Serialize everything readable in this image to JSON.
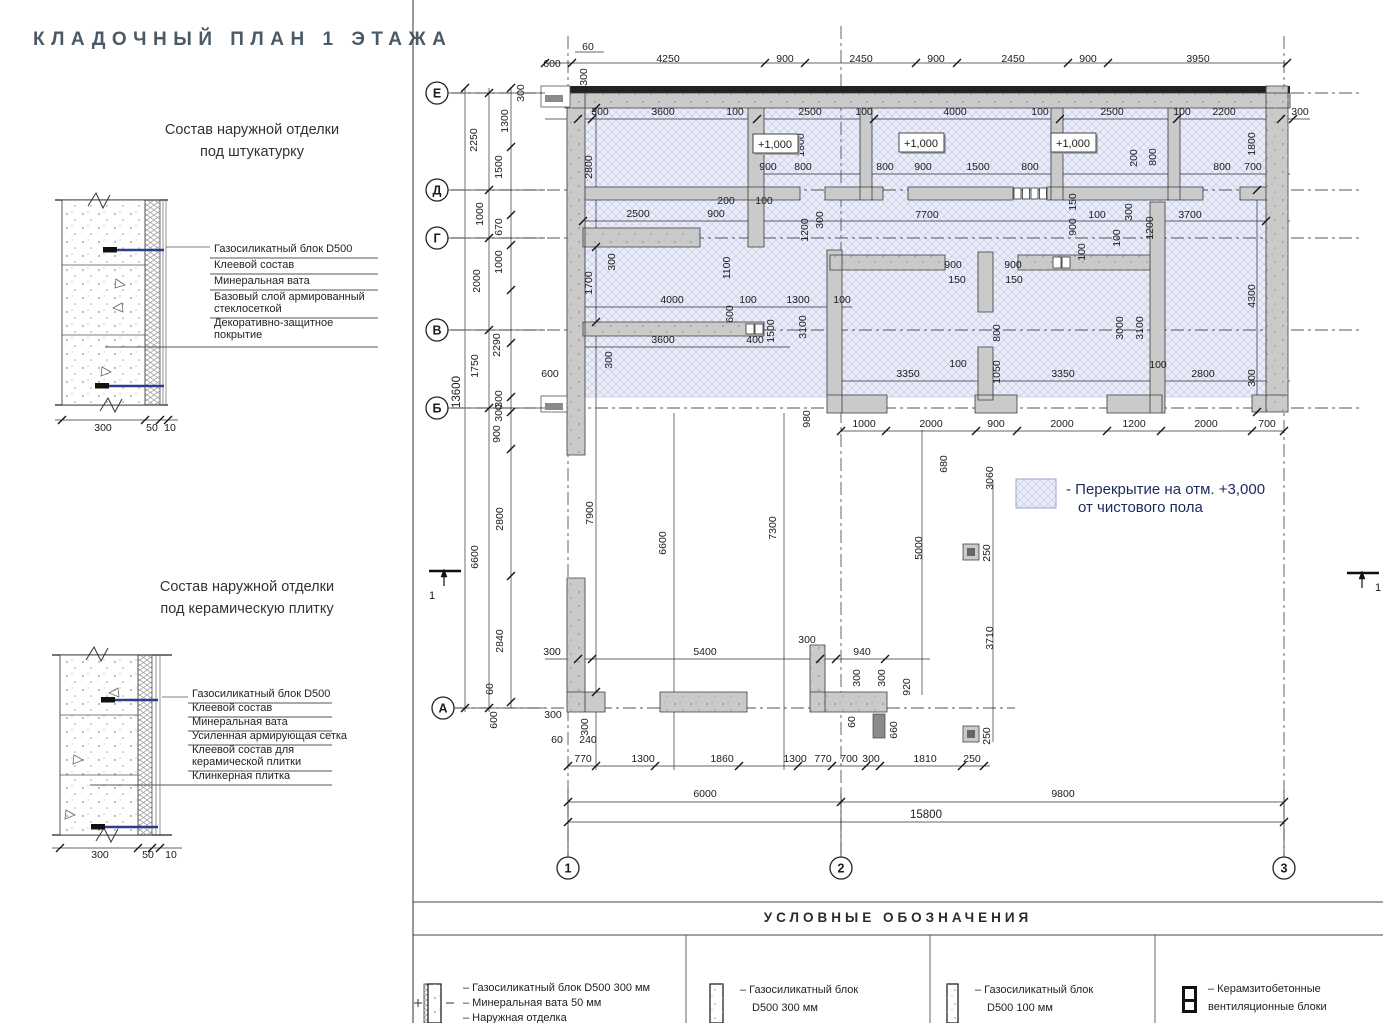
{
  "page": {
    "title": "КЛАДОЧНЫЙ ПЛАН 1 ЭТАЖА"
  },
  "details": [
    {
      "title1": "Состав наружной отделки",
      "title2": "под штукатурку",
      "layer_lines": [
        "Газосиликатный блок D500",
        "Клеевой состав",
        "Минеральная вата",
        "Базовый слой армированный",
        "стеклосеткой",
        "Декоративно-защитное",
        "покрытие"
      ],
      "dims": [
        "300",
        "50",
        "10"
      ]
    },
    {
      "title1": "Состав наружной отделки",
      "title2": "под керамическую плитку",
      "layer_lines": [
        "Газосиликатный блок D500",
        "Клеевой состав",
        "Минеральная вата",
        "Усиленная армирующая сетка",
        "Клеевой состав для",
        "керамической плитки",
        "Клинкерная плитка"
      ],
      "dims": [
        "300",
        "50",
        "10"
      ]
    }
  ],
  "plan": {
    "grid_rows": [
      {
        "label": "Е",
        "x": 437,
        "y": 93
      },
      {
        "label": "Д",
        "x": 437,
        "y": 190
      },
      {
        "label": "Г",
        "x": 437,
        "y": 238
      },
      {
        "label": "В",
        "x": 437,
        "y": 330
      },
      {
        "label": "Б",
        "x": 437,
        "y": 408
      },
      {
        "label": "А",
        "x": 443,
        "y": 708
      }
    ],
    "grid_cols": [
      {
        "label": "1",
        "x": 568,
        "y": 868
      },
      {
        "label": "2",
        "x": 841,
        "y": 868
      },
      {
        "label": "3",
        "x": 1284,
        "y": 868
      }
    ],
    "levels": [
      {
        "t": "+1,000",
        "x": 775,
        "y": 144
      },
      {
        "t": "+1,000",
        "x": 921,
        "y": 143
      },
      {
        "t": "+1,000",
        "x": 1073,
        "y": 143
      }
    ],
    "slab_note": [
      "- Перекрытие на отм. +3,000",
      "от чистового пола"
    ],
    "section_marks": [
      {
        "t": "1",
        "x": 432,
        "y": 599
      },
      {
        "t": "1",
        "x": 1378,
        "y": 591
      }
    ],
    "dims_h": [
      {
        "t": "60",
        "x": 588,
        "y": 50
      },
      {
        "t": "600",
        "x": 552,
        "y": 67
      },
      {
        "t": "4250",
        "x": 668,
        "y": 62
      },
      {
        "t": "900",
        "x": 785,
        "y": 62
      },
      {
        "t": "2450",
        "x": 861,
        "y": 62
      },
      {
        "t": "900",
        "x": 936,
        "y": 62
      },
      {
        "t": "2450",
        "x": 1013,
        "y": 62
      },
      {
        "t": "900",
        "x": 1088,
        "y": 62
      },
      {
        "t": "3950",
        "x": 1198,
        "y": 62
      },
      {
        "t": "300",
        "x": 600,
        "y": 115
      },
      {
        "t": "3600",
        "x": 663,
        "y": 115
      },
      {
        "t": "100",
        "x": 735,
        "y": 115
      },
      {
        "t": "2500",
        "x": 810,
        "y": 115
      },
      {
        "t": "100",
        "x": 864,
        "y": 115
      },
      {
        "t": "4000",
        "x": 955,
        "y": 115
      },
      {
        "t": "100",
        "x": 1040,
        "y": 115
      },
      {
        "t": "2500",
        "x": 1112,
        "y": 115
      },
      {
        "t": "100",
        "x": 1182,
        "y": 115
      },
      {
        "t": "2200",
        "x": 1224,
        "y": 115
      },
      {
        "t": "300",
        "x": 1300,
        "y": 115
      },
      {
        "t": "900",
        "x": 768,
        "y": 170
      },
      {
        "t": "800",
        "x": 803,
        "y": 170
      },
      {
        "t": "800",
        "x": 885,
        "y": 170
      },
      {
        "t": "900",
        "x": 923,
        "y": 170
      },
      {
        "t": "1500",
        "x": 978,
        "y": 170
      },
      {
        "t": "800",
        "x": 1030,
        "y": 170
      },
      {
        "t": "800",
        "x": 1222,
        "y": 170
      },
      {
        "t": "700",
        "x": 1253,
        "y": 170
      },
      {
        "t": "200",
        "x": 726,
        "y": 204
      },
      {
        "t": "100",
        "x": 764,
        "y": 204
      },
      {
        "t": "2500",
        "x": 638,
        "y": 217
      },
      {
        "t": "900",
        "x": 716,
        "y": 217
      },
      {
        "t": "7700",
        "x": 927,
        "y": 218
      },
      {
        "t": "100",
        "x": 1097,
        "y": 218
      },
      {
        "t": "3700",
        "x": 1190,
        "y": 218
      },
      {
        "t": "900",
        "x": 953,
        "y": 268
      },
      {
        "t": "900",
        "x": 1013,
        "y": 268
      },
      {
        "t": "150",
        "x": 957,
        "y": 283
      },
      {
        "t": "150",
        "x": 1014,
        "y": 283
      },
      {
        "t": "4000",
        "x": 672,
        "y": 303
      },
      {
        "t": "100",
        "x": 748,
        "y": 303
      },
      {
        "t": "1300",
        "x": 798,
        "y": 303
      },
      {
        "t": "100",
        "x": 842,
        "y": 303
      },
      {
        "t": "3600",
        "x": 663,
        "y": 343
      },
      {
        "t": "400",
        "x": 755,
        "y": 343
      },
      {
        "t": "600",
        "x": 550,
        "y": 377
      },
      {
        "t": "3350",
        "x": 908,
        "y": 377
      },
      {
        "t": "100",
        "x": 958,
        "y": 367
      },
      {
        "t": "3350",
        "x": 1063,
        "y": 377
      },
      {
        "t": "100",
        "x": 1158,
        "y": 368
      },
      {
        "t": "2800",
        "x": 1203,
        "y": 377
      },
      {
        "t": "1000",
        "x": 864,
        "y": 427
      },
      {
        "t": "2000",
        "x": 931,
        "y": 427
      },
      {
        "t": "900",
        "x": 996,
        "y": 427
      },
      {
        "t": "2000",
        "x": 1062,
        "y": 427
      },
      {
        "t": "1200",
        "x": 1134,
        "y": 427
      },
      {
        "t": "2000",
        "x": 1206,
        "y": 427
      },
      {
        "t": "700",
        "x": 1267,
        "y": 427
      },
      {
        "t": "300",
        "x": 552,
        "y": 655
      },
      {
        "t": "5400",
        "x": 705,
        "y": 655
      },
      {
        "t": "300",
        "x": 807,
        "y": 643
      },
      {
        "t": "940",
        "x": 862,
        "y": 655
      },
      {
        "t": "300",
        "x": 553,
        "y": 718
      },
      {
        "t": "60",
        "x": 557,
        "y": 743
      },
      {
        "t": "240",
        "x": 588,
        "y": 743
      },
      {
        "t": "770",
        "x": 583,
        "y": 762
      },
      {
        "t": "1300",
        "x": 643,
        "y": 762
      },
      {
        "t": "1860",
        "x": 722,
        "y": 762
      },
      {
        "t": "1300",
        "x": 795,
        "y": 762
      },
      {
        "t": "770",
        "x": 823,
        "y": 762
      },
      {
        "t": "700",
        "x": 849,
        "y": 762
      },
      {
        "t": "300",
        "x": 871,
        "y": 762
      },
      {
        "t": "1810",
        "x": 925,
        "y": 762
      },
      {
        "t": "250",
        "x": 972,
        "y": 762
      },
      {
        "t": "6000",
        "x": 705,
        "y": 797
      },
      {
        "t": "9800",
        "x": 1063,
        "y": 797
      },
      {
        "t": "15800",
        "x": 926,
        "y": 818
      }
    ],
    "dims_v": [
      {
        "t": "300",
        "x": 524,
        "y": 93
      },
      {
        "t": "300",
        "x": 587,
        "y": 77
      },
      {
        "t": "1300",
        "x": 508,
        "y": 121
      },
      {
        "t": "2250",
        "x": 477,
        "y": 140
      },
      {
        "t": "1500",
        "x": 502,
        "y": 167
      },
      {
        "t": "1000",
        "x": 483,
        "y": 214
      },
      {
        "t": "670",
        "x": 502,
        "y": 227
      },
      {
        "t": "1000",
        "x": 502,
        "y": 262
      },
      {
        "t": "2000",
        "x": 480,
        "y": 281
      },
      {
        "t": "2290",
        "x": 500,
        "y": 345
      },
      {
        "t": "1750",
        "x": 478,
        "y": 366
      },
      {
        "t": "13600",
        "x": 460,
        "y": 392
      },
      {
        "t": "300",
        "x": 502,
        "y": 399
      },
      {
        "t": "300",
        "x": 502,
        "y": 413
      },
      {
        "t": "900",
        "x": 500,
        "y": 434
      },
      {
        "t": "2800",
        "x": 503,
        "y": 519
      },
      {
        "t": "6600",
        "x": 478,
        "y": 557
      },
      {
        "t": "2840",
        "x": 503,
        "y": 641
      },
      {
        "t": "60",
        "x": 493,
        "y": 689
      },
      {
        "t": "600",
        "x": 497,
        "y": 720
      },
      {
        "t": "300",
        "x": 588,
        "y": 727
      },
      {
        "t": "2800",
        "x": 592,
        "y": 167
      },
      {
        "t": "1700",
        "x": 592,
        "y": 283
      },
      {
        "t": "7900",
        "x": 593,
        "y": 513
      },
      {
        "t": "300",
        "x": 615,
        "y": 262
      },
      {
        "t": "300",
        "x": 612,
        "y": 360
      },
      {
        "t": "1100",
        "x": 730,
        "y": 268
      },
      {
        "t": "600",
        "x": 733,
        "y": 314
      },
      {
        "t": "1500",
        "x": 774,
        "y": 331
      },
      {
        "t": "3100",
        "x": 806,
        "y": 327
      },
      {
        "t": "1800",
        "x": 804,
        "y": 145
      },
      {
        "t": "1800",
        "x": 1255,
        "y": 144
      },
      {
        "t": "200",
        "x": 1137,
        "y": 158
      },
      {
        "t": "800",
        "x": 1156,
        "y": 157
      },
      {
        "t": "300",
        "x": 1132,
        "y": 212
      },
      {
        "t": "1200",
        "x": 1153,
        "y": 228
      },
      {
        "t": "100",
        "x": 1120,
        "y": 238
      },
      {
        "t": "1200",
        "x": 808,
        "y": 230
      },
      {
        "t": "300",
        "x": 823,
        "y": 220
      },
      {
        "t": "150",
        "x": 1076,
        "y": 202
      },
      {
        "t": "900",
        "x": 1076,
        "y": 227
      },
      {
        "t": "100",
        "x": 1085,
        "y": 252
      },
      {
        "t": "800",
        "x": 1000,
        "y": 333
      },
      {
        "t": "1050",
        "x": 1000,
        "y": 372
      },
      {
        "t": "3000",
        "x": 1123,
        "y": 328
      },
      {
        "t": "3100",
        "x": 1143,
        "y": 328
      },
      {
        "t": "4300",
        "x": 1255,
        "y": 296
      },
      {
        "t": "300",
        "x": 1255,
        "y": 378
      },
      {
        "t": "980",
        "x": 810,
        "y": 419
      },
      {
        "t": "680",
        "x": 947,
        "y": 464
      },
      {
        "t": "3060",
        "x": 993,
        "y": 478
      },
      {
        "t": "5000",
        "x": 922,
        "y": 548
      },
      {
        "t": "3710",
        "x": 993,
        "y": 638
      },
      {
        "t": "250",
        "x": 990,
        "y": 553
      },
      {
        "t": "250",
        "x": 990,
        "y": 736
      },
      {
        "t": "300",
        "x": 860,
        "y": 678
      },
      {
        "t": "300",
        "x": 885,
        "y": 678
      },
      {
        "t": "920",
        "x": 910,
        "y": 687
      },
      {
        "t": "660",
        "x": 897,
        "y": 730
      },
      {
        "t": "60",
        "x": 855,
        "y": 722
      },
      {
        "t": "6600",
        "x": 666,
        "y": 543
      },
      {
        "t": "7300",
        "x": 776,
        "y": 528
      }
    ]
  },
  "legend": {
    "title": "УСЛОВНЫЕ ОБОЗНАЧЕНИЯ",
    "items": [
      {
        "lines": [
          "– Газосиликатный блок D500 300 мм",
          "– Минеральная вата 50 мм",
          "– Наружная отделка"
        ]
      },
      {
        "lines": [
          "– Газосиликатный блок",
          "D500 300 мм"
        ]
      },
      {
        "lines": [
          "– Газосиликатный блок",
          "D500 100 мм"
        ]
      },
      {
        "lines": [
          "– Керамзитобетонные",
          "вентиляционные блоки"
        ]
      }
    ]
  },
  "colors": {
    "wall_fill": "#cacaca",
    "wall_dark": "#222222",
    "slab_fill": "#eaecf8",
    "slab_line": "#bcc4e6",
    "anchor_blue": "#2c3c8e",
    "note_blue": "#1a2a5e",
    "title_gray": "#4b5a67"
  }
}
